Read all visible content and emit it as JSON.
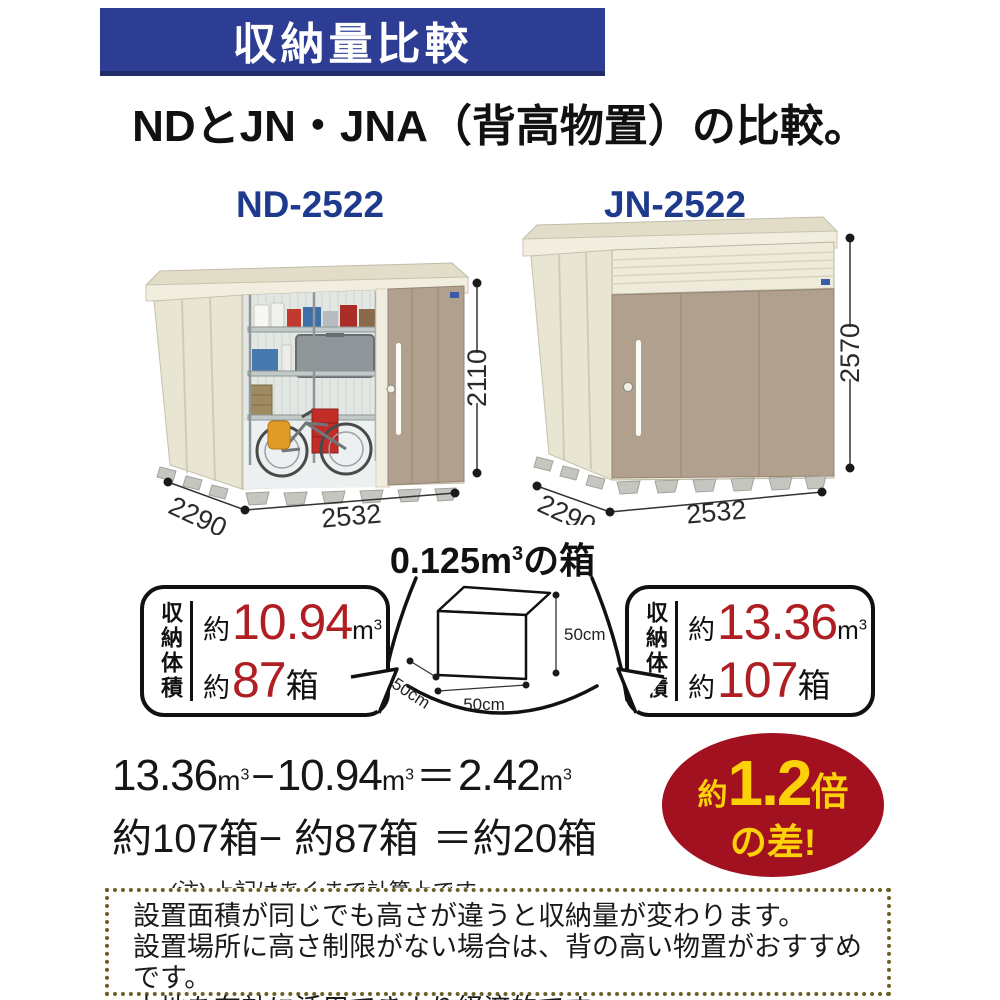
{
  "header": {
    "banner": "収納量比較",
    "title": "NDとJN・JNA（背高物置）の比較。"
  },
  "sheds": {
    "left": {
      "model": "ND-2522",
      "width": "2532",
      "depth": "2290",
      "height": "2110"
    },
    "right": {
      "model": "JN-2522",
      "width": "2532",
      "depth": "2290",
      "height": "2570"
    }
  },
  "box_figure": {
    "title_value": "0.125",
    "title_unit_base": "m",
    "title_unit_sup": "3",
    "title_suffix": "の箱",
    "dim_height": "50cm",
    "dim_width": "50cm",
    "dim_depth": "50cm"
  },
  "callouts": {
    "left": {
      "label": "収納体積",
      "volume_prefix": "約",
      "volume_value": "10.94",
      "unit_base": "m",
      "unit_sup": "3",
      "count_prefix": "約",
      "count_value": "87",
      "count_unit": "箱"
    },
    "right": {
      "label": "収納体積",
      "volume_prefix": "約",
      "volume_value": "13.36",
      "unit_base": "m",
      "unit_sup": "3",
      "count_prefix": "約",
      "count_value": "107",
      "count_unit": "箱"
    }
  },
  "calculation": {
    "v1": "13.36",
    "v2": "10.94",
    "v3": "2.42",
    "unit_base": "m",
    "unit_sup": "3",
    "minus": "−",
    "equals": "＝",
    "c1": "約107箱",
    "c_minus": "−",
    "c2": "約87箱",
    "c_eq": "＝",
    "c3": "約20箱",
    "note": "(注) 上記はあくまで計算上です。"
  },
  "badge": {
    "prefix": "約",
    "value": "1.2",
    "suffix": "倍",
    "line2": "の差!"
  },
  "info_box": {
    "lines": [
      "設置面積が同じでも高さが違うと収納量が変わります。",
      "設置場所に高さ制限がない場合は、背の高い物置がおすすめです。",
      "土地を有効に活用できより経済的です。"
    ]
  },
  "colors": {
    "banner_blue": "#2d3d93",
    "model_navy": "#1d3a8d",
    "number_red": "#af1e23",
    "badge_red": "#a11120",
    "badge_yellow": "#fdd108",
    "shed_cream": "#eae6d3",
    "door_tan": "#b2a08f",
    "dotted_border": "#6d5e26"
  }
}
